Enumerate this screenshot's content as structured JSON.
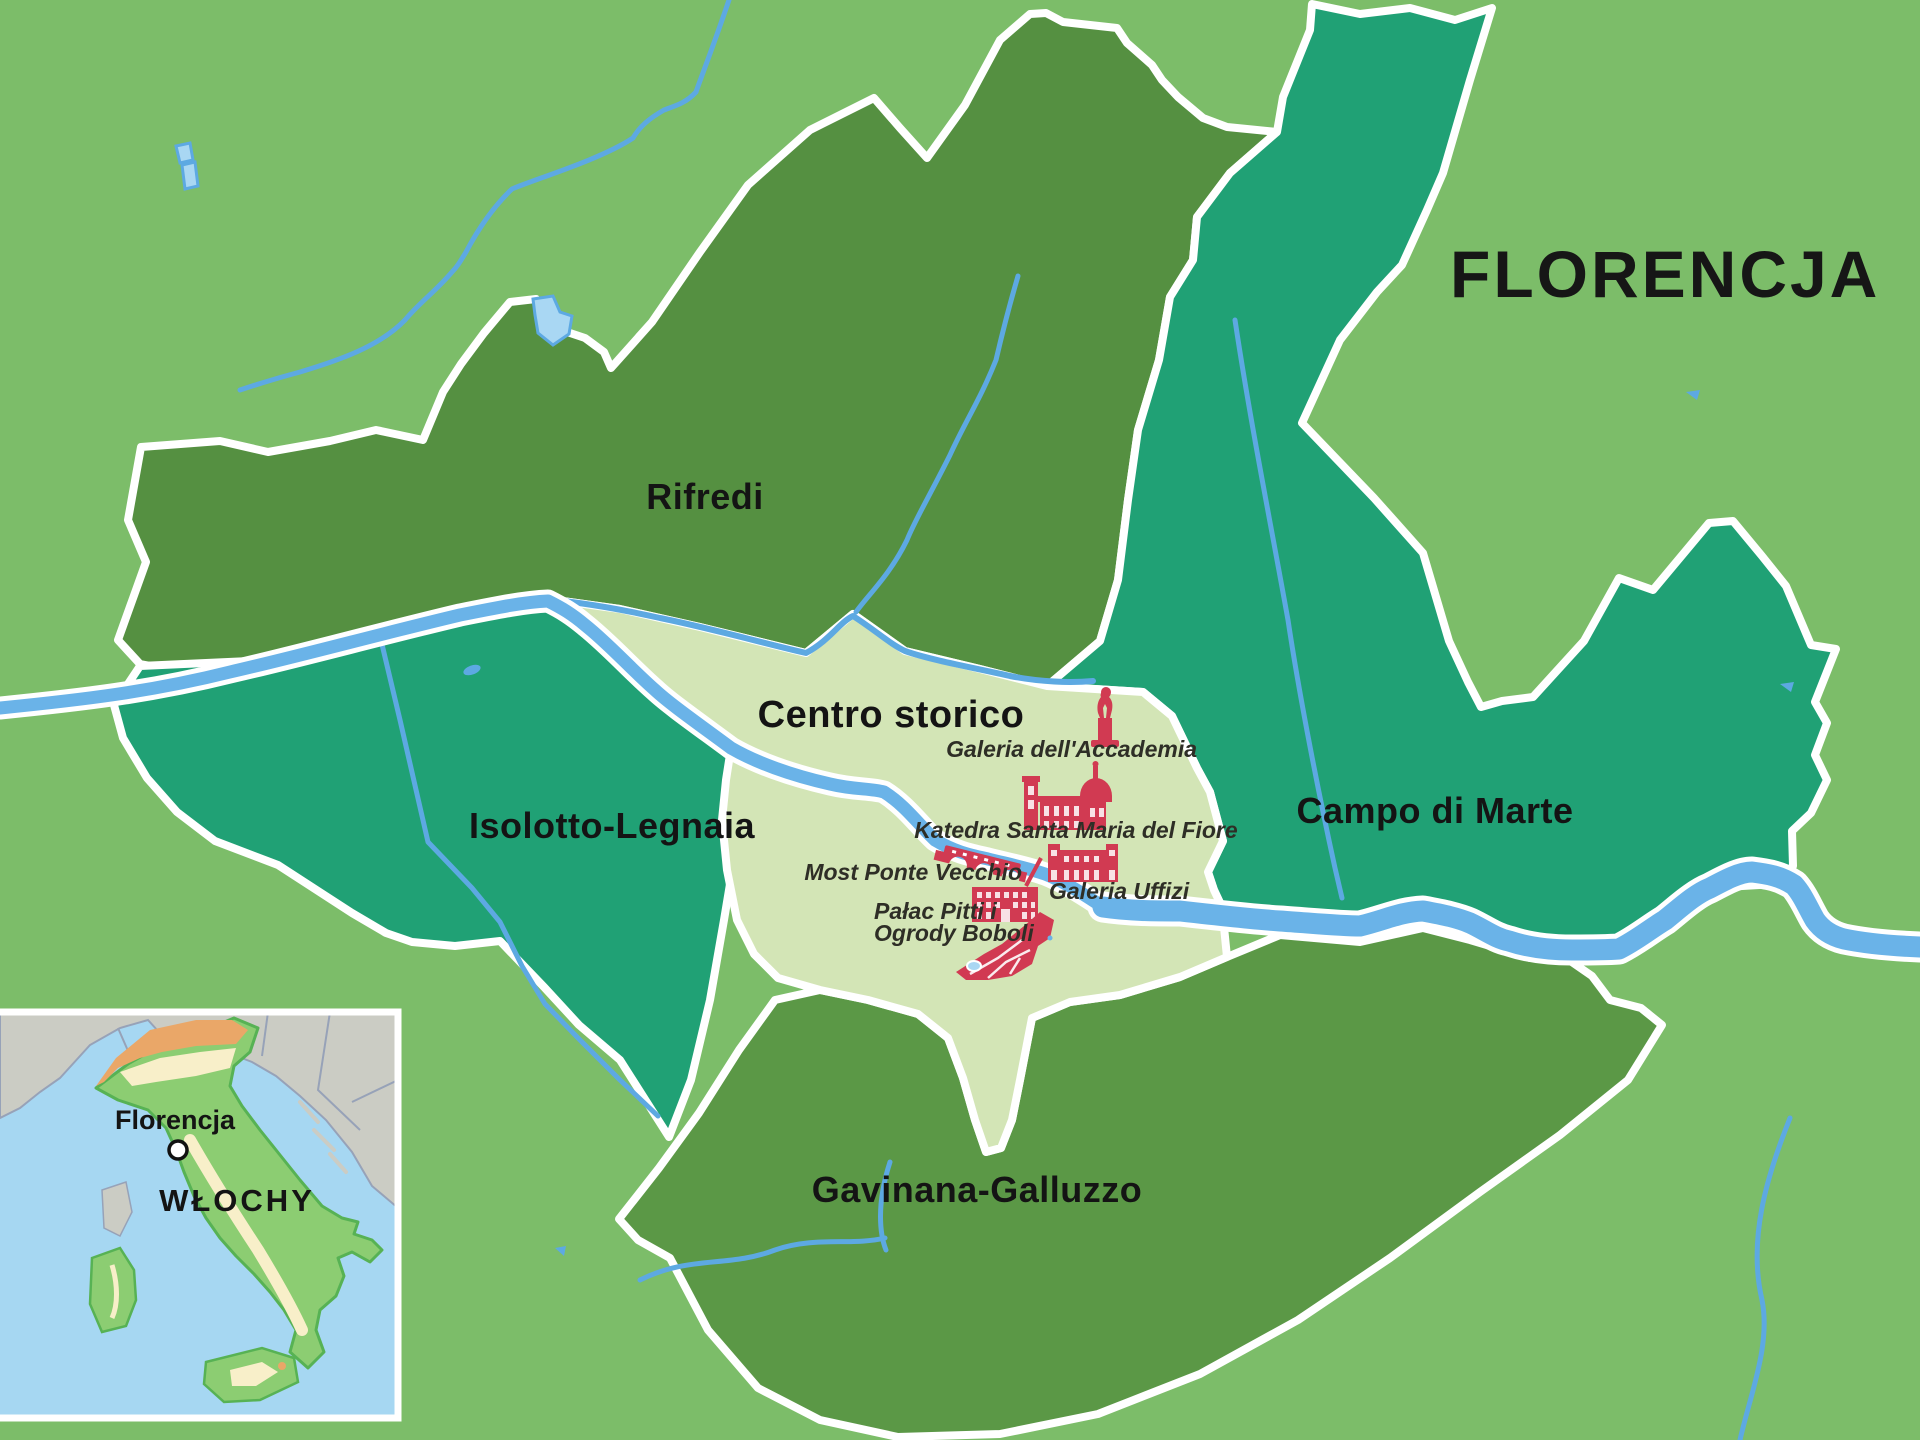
{
  "title": "FLORENCJA",
  "districts": {
    "rifredi": "Rifredi",
    "isolotto_legnaia": "Isolotto-Legnaia",
    "centro_storico": "Centro storico",
    "campo_di_marte": "Campo di Marte",
    "gavinana_galluzzo": "Gavinana-Galluzzo"
  },
  "landmarks": {
    "galeria_accademia": "Galeria dell'Accademia",
    "katedra": "Katedra Santa Maria del Fiore",
    "most_ponte_vecchio": "Most Ponte Vecchio",
    "galeria_uffizi": "Galeria Uffizi",
    "palac_pitti_line1": "Pałac Pitti i",
    "palac_pitti_line2": "Ogrody Boboli"
  },
  "inset": {
    "city_label": "Florencja",
    "country_label": "WŁOCHY"
  },
  "colors": {
    "background": "#7cbd69",
    "district_green_dark": "#559041",
    "district_green": "#5b9846",
    "district_teal": "#20a175",
    "district_pale": "#d3e5b6",
    "water": "#6ab3e8",
    "water_light": "#a9d7f3",
    "landmark_red": "#d13a52",
    "outline_white": "#ffffff",
    "text_dark": "#161616",
    "inset_sea": "#a6d7f2",
    "inset_land_gray": "#cbccc4",
    "inset_italy_green": "#8ccd72",
    "inset_italy_cream": "#f8efc9",
    "inset_italy_orange": "#eaa768"
  }
}
